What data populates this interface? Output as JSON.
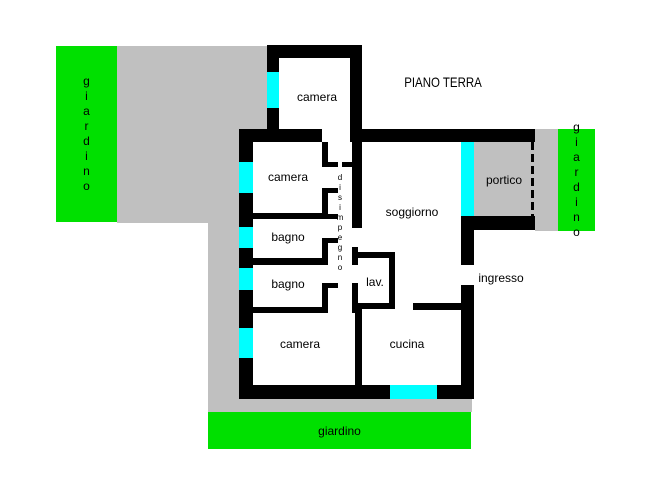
{
  "title": "PIANO TERRA",
  "colors": {
    "wall": "#000000",
    "window": "#00ffff",
    "garden": "#00e000",
    "paved": "#c0c0c0",
    "floor": "#ffffff",
    "text": "#000000"
  },
  "labels": {
    "camera_top": "camera",
    "camera_mid": "camera",
    "camera_bottom": "camera",
    "bagno_top": "bagno",
    "bagno_bottom": "bagno",
    "soggiorno": "soggiorno",
    "cucina": "cucina",
    "lav": "lav.",
    "ingresso": "ingresso",
    "portico": "portico",
    "disimpegno": "disimpegno",
    "garden_left": "giardino",
    "garden_right": "giardino",
    "garden_bottom": "giardino"
  }
}
